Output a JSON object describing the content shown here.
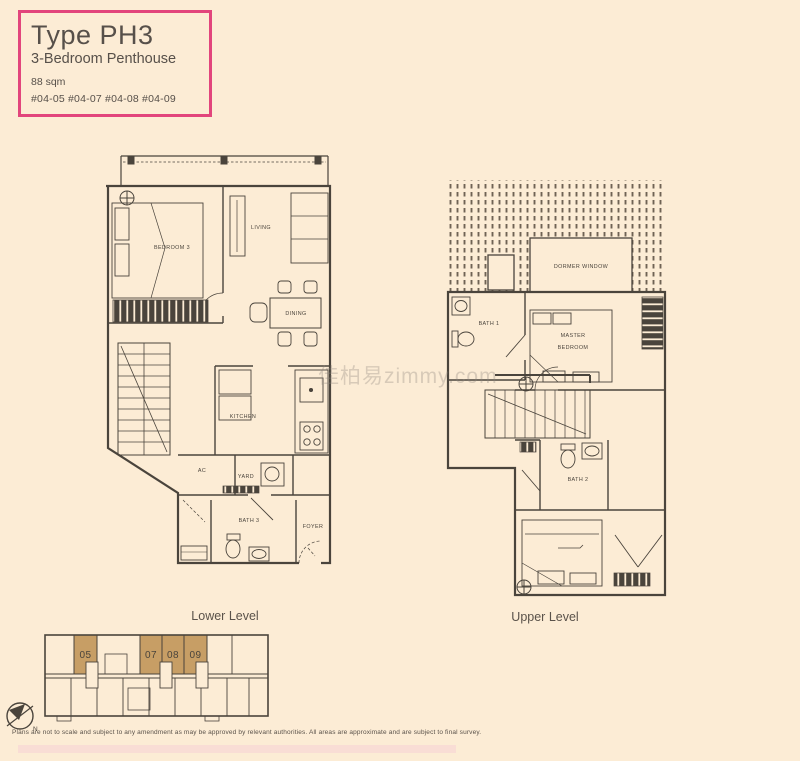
{
  "page": {
    "background": "#fcecd5",
    "line_color": "#4a443c"
  },
  "title_card": {
    "title": "Type PH3",
    "subtitle": "3-Bedroom Penthouse",
    "area": "88 sqm",
    "units": "#04-05 #04-07 #04-08 #04-09",
    "border_color": "#e2457c"
  },
  "lower_plan": {
    "caption": "Lower Level",
    "rooms": {
      "bedroom3": "BEDROOM 3",
      "living": "LIVING",
      "dining": "DINING",
      "kitchen": "KITCHEN",
      "ac": "AC",
      "yard": "YARD",
      "bath3": "BATH 3",
      "foyer": "FOYER"
    }
  },
  "upper_plan": {
    "caption": "Upper Level",
    "rooms": {
      "dormer_window": "DORMER WINDOW",
      "bath1": "BATH 1",
      "master_line1": "MASTER",
      "master_line2": "BEDROOM",
      "bath2": "BATH 2"
    }
  },
  "unit_locator": {
    "highlight_color": "#c79e65",
    "units": [
      "05",
      "07",
      "08",
      "09"
    ],
    "north": "N"
  },
  "watermark": "佳柏易zimmy.com",
  "disclaimer": "Plans are not to scale and subject to any amendment as may be approved by relevant authorities. All areas are approximate and are subject to final survey."
}
